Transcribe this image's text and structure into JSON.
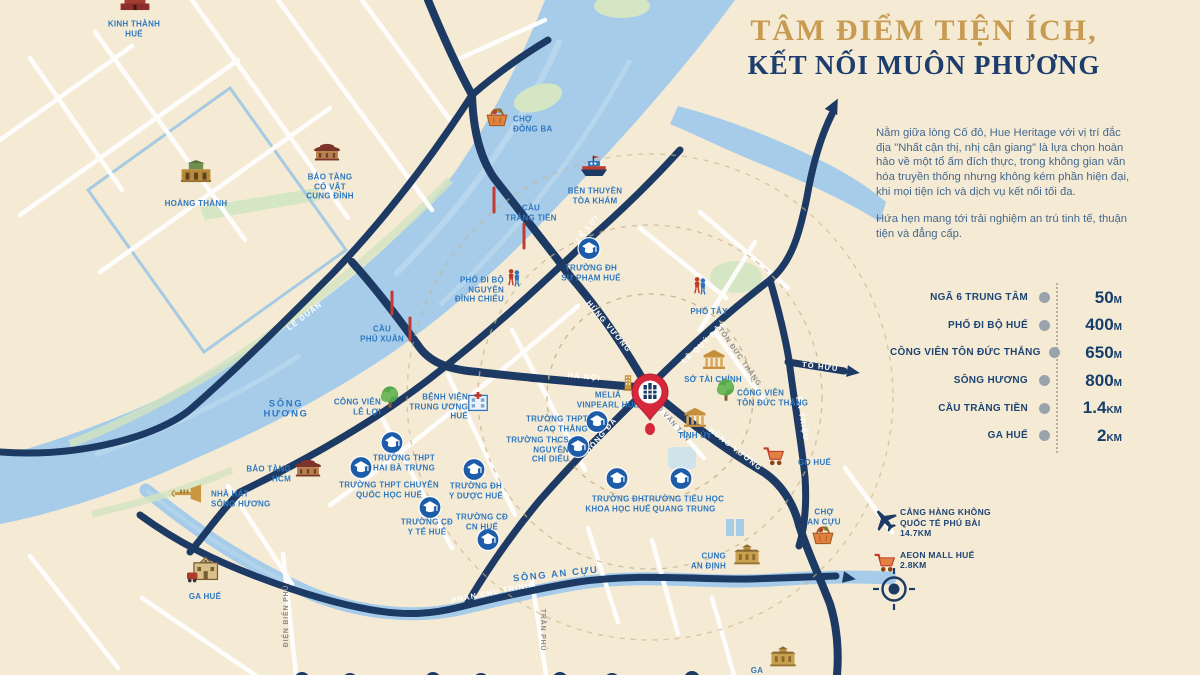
{
  "header": {
    "title_line1": "TÂM ĐIỂM TIỆN ÍCH,",
    "title_line2": "KẾT NỐI MUÔN PHƯƠNG"
  },
  "intro": {
    "p1": "Nằm giữa lòng Cố đô, Hue Heritage với vị trí đắc địa \"Nhất cận thị, nhị cận giang\" là lựa chọn hoàn hảo về một tổ ấm đích thực, trong không gian văn hóa truyền thống nhưng không kém phần hiện đại, khi mọi tiện ích và dịch vụ kết nối tối đa.",
    "p2": "Hứa hẹn mang tới trải nghiệm an trú tinh tế, thuận tiện và đẳng cấp."
  },
  "distances": [
    {
      "label": "NGÃ 6 TRUNG TÂM",
      "value": "50",
      "unit": "M"
    },
    {
      "label": "PHỐ ĐI BỘ HUẾ",
      "value": "400",
      "unit": "M"
    },
    {
      "label": "CÔNG VIÊN TÔN ĐỨC THẮNG",
      "value": "650",
      "unit": "M"
    },
    {
      "label": "SÔNG HƯƠNG",
      "value": "800",
      "unit": "M"
    },
    {
      "label": "CẦU TRÀNG TIỀN",
      "value": "1.4",
      "unit": "KM"
    },
    {
      "label": "GA HUẾ",
      "value": "2",
      "unit": "KM"
    }
  ],
  "legend": [
    {
      "icon": "plane",
      "text": "CẢNG HÀNG KHÔNG\nQUỐC TẾ PHÚ BÀI\n14.7KM"
    },
    {
      "icon": "cart",
      "text": "AEON MALL HUẾ\n2.8KM"
    }
  ],
  "colors": {
    "background": "#f5ebd5",
    "river": "#a6cce9",
    "road": "#1d3a64",
    "poi_text": "#2f78c0",
    "title_gold": "#c89b52",
    "title_navy": "#1c3d6e",
    "pin_red": "#d6273b"
  },
  "map": {
    "project": {
      "x": 650,
      "y": 395
    },
    "road_labels": [
      {
        "id": "le-duan",
        "text": "LÊ DUẨN",
        "x": 306,
        "y": 318,
        "rot": -37,
        "style": "onroad"
      },
      {
        "id": "le-loi",
        "text": "LÊ LỢI",
        "x": 589,
        "y": 230,
        "rot": -50,
        "style": "onroad"
      },
      {
        "id": "hung-vuong-north",
        "text": "HÙNG VƯƠNG",
        "x": 607,
        "y": 328,
        "rot": 50,
        "style": "onroad"
      },
      {
        "id": "ha-noi",
        "text": "HÀ NỘI",
        "x": 584,
        "y": 379,
        "rot": 6,
        "style": "onroad"
      },
      {
        "id": "le-quy-don",
        "text": "LÊ QUÝ ĐÔN",
        "x": 706,
        "y": 344,
        "rot": -43,
        "style": "onroad"
      },
      {
        "id": "ton-duc-thang-street",
        "text": "TÔN ĐỨC THẮNG",
        "x": 738,
        "y": 358,
        "rot": 55,
        "style": "minor"
      },
      {
        "id": "to-huu",
        "text": "TỐ HỮU",
        "x": 820,
        "y": 369,
        "rot": 7,
        "style": "onroad"
      },
      {
        "id": "ba-trieu",
        "text": "BÀ TRIỆU",
        "x": 800,
        "y": 419,
        "rot": 80,
        "style": "onroad"
      },
      {
        "id": "hung-vuong-south",
        "text": "HÙNG VƯƠNG",
        "x": 734,
        "y": 451,
        "rot": 38,
        "style": "onroad"
      },
      {
        "id": "dong-da",
        "text": "ĐỐNG ĐA",
        "x": 603,
        "y": 437,
        "rot": -50,
        "style": "onroad"
      },
      {
        "id": "vo-van-tan",
        "text": "VÕ VĂN TẦN",
        "x": 670,
        "y": 423,
        "rot": 48,
        "style": "minor"
      },
      {
        "id": "phan-chu-trinh",
        "text": "PHAN CHU TRINH",
        "x": 492,
        "y": 595,
        "rot": -11,
        "style": "onroad"
      },
      {
        "id": "dien-bien-phu",
        "text": "ĐIỆN BIÊN PHỦ",
        "x": 288,
        "y": 616,
        "rot": -90,
        "style": "minor"
      },
      {
        "id": "tran-phu",
        "text": "TRẦN PHÚ",
        "x": 541,
        "y": 630,
        "rot": 90,
        "style": "minor"
      },
      {
        "id": "song-an-cuu",
        "text": "SÔNG AN CỰU",
        "x": 556,
        "y": 577,
        "rot": -6,
        "style": "river"
      }
    ],
    "pois": [
      {
        "id": "kinh-thanh-hue",
        "icon": "citadel",
        "ix": 135,
        "iy": 6,
        "label": "KINH THÀNH\nHUẾ",
        "lx": 134,
        "ly": 29,
        "align": "c"
      },
      {
        "id": "hoang-thanh",
        "icon": "gate",
        "ix": 196,
        "iy": 177,
        "label": "HOÀNG THÀNH",
        "lx": 196,
        "ly": 204,
        "align": "c"
      },
      {
        "id": "bao-tang-co-vat-cung-dinh",
        "icon": "pavilion",
        "ix": 327,
        "iy": 155,
        "label": "BẢO TÀNG\nCỔ VẬT\nCUNG ĐÌNH",
        "lx": 330,
        "ly": 187,
        "align": "c"
      },
      {
        "id": "cho-dong-ba",
        "icon": "basket",
        "ix": 497,
        "iy": 120,
        "label": "CHỢ\nĐÔNG BA",
        "lx": 513,
        "ly": 124,
        "align": "l"
      },
      {
        "id": "cau-trang-tien",
        "icon": null,
        "label": "CẦU\nTRÀNG TIỀN",
        "lx": 531,
        "ly": 213,
        "align": "c"
      },
      {
        "id": "ben-thuyen-toa-kham",
        "icon": "boat",
        "ix": 594,
        "iy": 170,
        "label": "BẾN THUYỀN\nTÒA KHÁM",
        "lx": 595,
        "ly": 196,
        "align": "c"
      },
      {
        "id": "pho-di-bo-nguyen-dinh-chieu",
        "icon": "people",
        "ix": 514,
        "iy": 282,
        "label": "PHỐ ĐI BỘ\nNGUYỄN\nĐÌNH CHIỂU",
        "lx": 504,
        "ly": 290,
        "align": "r"
      },
      {
        "id": "cau-phu-xuan",
        "icon": null,
        "label": "CẦU\nPHÚ XUÂN",
        "lx": 382,
        "ly": 334,
        "align": "c"
      },
      {
        "id": "truong-dh-su-pham-hue",
        "icon": "school",
        "ix": 589,
        "iy": 251,
        "label": "TRƯỜNG ĐH\nSƯ PHẠM HUẾ",
        "lx": 591,
        "ly": 273,
        "align": "c"
      },
      {
        "id": "pho-tay",
        "icon": "people",
        "ix": 700,
        "iy": 290,
        "label": "PHỐ TÂY",
        "lx": 709,
        "ly": 312,
        "align": "c"
      },
      {
        "id": "so-tai-chinh",
        "icon": "govt",
        "ix": 714,
        "iy": 362,
        "label": "SỞ TÀI CHÍNH",
        "lx": 713,
        "ly": 380,
        "align": "c"
      },
      {
        "id": "cong-vien-ton-duc-thang",
        "icon": "tree",
        "ix": 726,
        "iy": 394,
        "label": "CÔNG VIÊN\nTÔN ĐỨC THẮNG",
        "lx": 737,
        "ly": 398,
        "align": "l"
      },
      {
        "id": "tinh-uy",
        "icon": "govt",
        "ix": 695,
        "iy": 420,
        "label": "TỈNH ỦY",
        "lx": 695,
        "ly": 436,
        "align": "c"
      },
      {
        "id": "melia-vinpearl-hue",
        "icon": "hotel",
        "ix": 628,
        "iy": 386,
        "label": "MELIÁ\nVINPEARL HUẾ",
        "lx": 608,
        "ly": 400,
        "align": "c"
      },
      {
        "id": "truong-thpt-cao-thang",
        "icon": "school",
        "ix": 597,
        "iy": 424,
        "label": "TRƯỜNG THPT\nCAO THẮNG",
        "lx": 588,
        "ly": 424,
        "align": "r"
      },
      {
        "id": "truong-thcs-nguyen-chi-dieu",
        "icon": "school",
        "ix": 578,
        "iy": 449,
        "label": "TRƯỜNG THCS\nNGUYỄN\nCHÍ DIỂU",
        "lx": 569,
        "ly": 450,
        "align": "r"
      },
      {
        "id": "benh-vien-trung-uong-hue",
        "icon": "hospital",
        "ix": 478,
        "iy": 406,
        "label": "BỆNH VIỆN\nTRUNG ƯƠNG\nHUẾ",
        "lx": 468,
        "ly": 407,
        "align": "r"
      },
      {
        "id": "cong-vien-le-loi",
        "icon": "tree",
        "ix": 390,
        "iy": 401,
        "label": "CÔNG VIÊN\nLÊ LỢI",
        "lx": 381,
        "ly": 407,
        "align": "r"
      },
      {
        "id": "song-huong",
        "icon": null,
        "label": "SÔNG\nHƯƠNG",
        "lx": 286,
        "ly": 409,
        "align": "c",
        "cls": "river-label"
      },
      {
        "id": "bao-tang-hcm",
        "icon": "pavilion",
        "ix": 308,
        "iy": 471,
        "label": "BẢO TÀNG\nHCM",
        "lx": 291,
        "ly": 474,
        "align": "r"
      },
      {
        "id": "nha-hat-song-huong",
        "icon": "trumpet",
        "ix": 188,
        "iy": 496,
        "label": "NHÀ HÁT\nSÔNG HƯƠNG",
        "lx": 211,
        "ly": 499,
        "align": "l"
      },
      {
        "id": "truong-thpt-hai-ba-trung",
        "icon": "school",
        "ix": 392,
        "iy": 445,
        "label": "TRƯỜNG THPT\nHAI BÀ TRƯNG",
        "lx": 404,
        "ly": 463,
        "align": "c"
      },
      {
        "id": "truong-thpt-chuyen-quoc-hoc-hue",
        "icon": "school",
        "ix": 361,
        "iy": 470,
        "label": "TRƯỜNG THPT CHUYÊN\nQUỐC HỌC HUẾ",
        "lx": 389,
        "ly": 490,
        "align": "c"
      },
      {
        "id": "truong-dh-y-duoc-hue",
        "icon": "school",
        "ix": 474,
        "iy": 472,
        "label": "TRƯỜNG ĐH\nY DƯỢC HUẾ",
        "lx": 476,
        "ly": 491,
        "align": "c"
      },
      {
        "id": "truong-cd-y-te-hue",
        "icon": "school",
        "ix": 430,
        "iy": 510,
        "label": "TRƯỜNG CĐ\nY TẾ HUẾ",
        "lx": 427,
        "ly": 527,
        "align": "c"
      },
      {
        "id": "truong-cd-cn-hue",
        "icon": "school",
        "ix": 488,
        "iy": 542,
        "label": "TRƯỜNG CĐ\nCN HUẾ",
        "lx": 482,
        "ly": 522,
        "align": "c"
      },
      {
        "id": "truong-dh-khoa-hoc-hue",
        "icon": "school",
        "ix": 617,
        "iy": 481,
        "label": "TRƯỜNG ĐH\nKHOA HỌC HUẾ",
        "lx": 618,
        "ly": 504,
        "align": "c"
      },
      {
        "id": "truong-tieu-hoc-quang-trung",
        "icon": "school",
        "ix": 681,
        "iy": 481,
        "label": "TRƯỜNG TIỂU HỌC\nQUANG TRUNG",
        "lx": 684,
        "ly": 504,
        "align": "c"
      },
      {
        "id": "go-hue",
        "icon": "cart",
        "ix": 774,
        "iy": 459,
        "label": "GO HUẾ",
        "lx": 798,
        "ly": 463,
        "align": "l"
      },
      {
        "id": "cho-an-cuu",
        "icon": "basket",
        "ix": 823,
        "iy": 538,
        "label": "CHỢ\nAN CỰU",
        "lx": 824,
        "ly": 517,
        "align": "c"
      },
      {
        "id": "cung-an-dinh",
        "icon": "palace",
        "ix": 747,
        "iy": 559,
        "label": "CUNG\nAN ĐỊNH",
        "lx": 726,
        "ly": 561,
        "align": "r"
      },
      {
        "id": "ga-hue",
        "icon": "station",
        "ix": 205,
        "iy": 575,
        "label": "GA HUẾ",
        "lx": 205,
        "ly": 597,
        "align": "c"
      },
      {
        "id": "ga-partial-bottom",
        "icon": "palace",
        "ix": 783,
        "iy": 661,
        "label": "GA",
        "lx": 757,
        "ly": 671,
        "align": "c"
      }
    ]
  }
}
